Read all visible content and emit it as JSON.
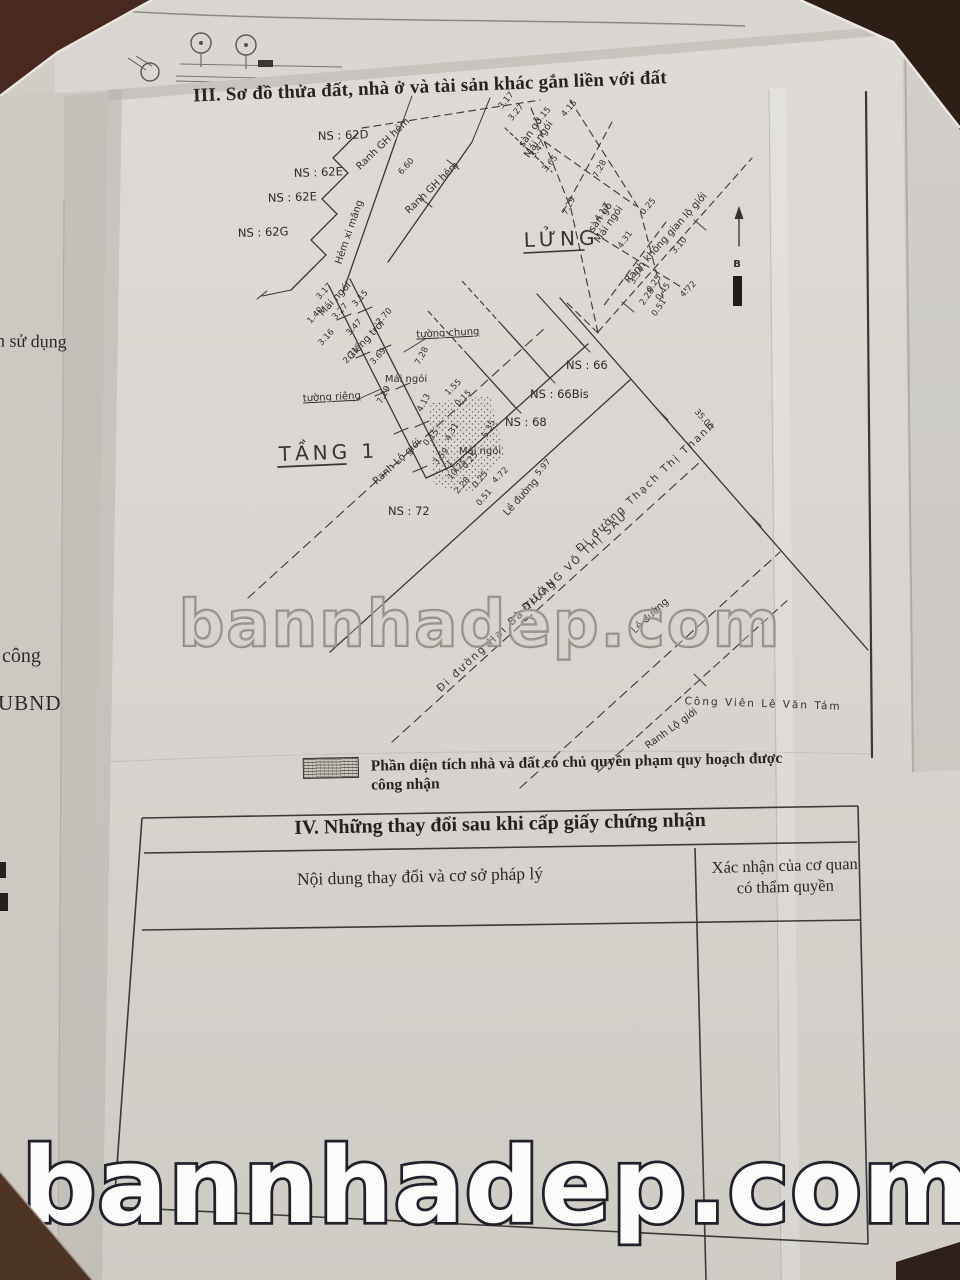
{
  "watermark": {
    "text": "bannhadep.com"
  },
  "title_section3": "III. Sơ đồ thửa đất, nhà ở và tài sản khác gắn liền với đất",
  "legend": {
    "label": "Phần diện tích nhà và đất có chủ quyền phạm quy hoạch được công nhận"
  },
  "section4": {
    "title": "IV. Những thay đổi sau khi cấp giấy chứng nhận",
    "col1_header": "Nội dung thay đổi và cơ sở pháp lý",
    "col2_header_line1": "Xác nhận của cơ quan",
    "col2_header_line2": "có thẩm quyền"
  },
  "underlying_page": {
    "fragment1": "n sử dụng",
    "fragment2": "công",
    "fragment3": "UBND"
  },
  "diagram": {
    "floors": {
      "lung": "LỬNG",
      "tang1": "TẦNG 1"
    },
    "parcels": {
      "ns62d": "NS : 62D",
      "ns62e_a": "NS : 62E",
      "ns62e_b": "NS : 62E",
      "ns62g": "NS : 62G",
      "ns66": "NS : 66",
      "ns66bis": "NS : 66Bis",
      "ns68": "NS : 68",
      "ns72": "NS : 72"
    },
    "features": {
      "ranh_gh_hem_a": "Ranh GH hẻm",
      "ranh_gh_hem_b": "Ranh GH hẻm",
      "hem_xi_mang": "Hẻm xi măng",
      "tuong_chung": "tường chung",
      "tuong_rieng": "tường riêng",
      "mai_ngoi_a": "Mái ngói",
      "mai_ngoi_b": "Mái ngói",
      "mai_ngoi_c": "Mái ngói",
      "gieng_troi": "Giếng trời",
      "san_go_a": "sàn gỗ",
      "mai_ngoi_d": "Mái ngói",
      "san_go_b": "sàn gỗ",
      "mai_ngoi_e": "Mái ngói",
      "ranh_lo_gioi_a": "Ranh Lộ giới",
      "ranh_lo_gioi_b": "Ranh Lộ giới",
      "ranh_khong_gian_lo_gioi": "Ranh không gian lộ giới",
      "le_duong_a": "Lề đường",
      "le_duong_b": "Lề đường",
      "duong_hai_ba_trung": "Đi đường Hai Bà Trưng",
      "duong_vo_thi_sau": "ĐƯỜNG VÕ THỊ SÁU",
      "duong_thach_thi_thanh": "Đi đường Thạch Thị Thanh",
      "cong_vien": "Công Viên Lê Văn Tám",
      "north": "B"
    },
    "measurements": [
      "3.17",
      "3.15",
      "3.27",
      "2.70",
      "1.40",
      "3.47",
      "3.16",
      "2.71",
      "3.69",
      "7.28",
      "7.29",
      "4.13",
      "1.55",
      "0.15",
      "4.31",
      "5.35",
      "3.59",
      "0.15",
      "10.25",
      "0.25",
      "0.25",
      "2.28",
      "0.51",
      "4.72",
      "5.97",
      "6.60",
      "3.17",
      "3.27",
      "3.15",
      "3.47",
      "3.65",
      "4.15",
      "7.28",
      "7.29",
      "4.13",
      "4.31",
      "0.25",
      "3.10",
      "3.34",
      "0.25",
      "2.28",
      "0.45",
      "4.72",
      "0.51",
      "35.00"
    ]
  }
}
